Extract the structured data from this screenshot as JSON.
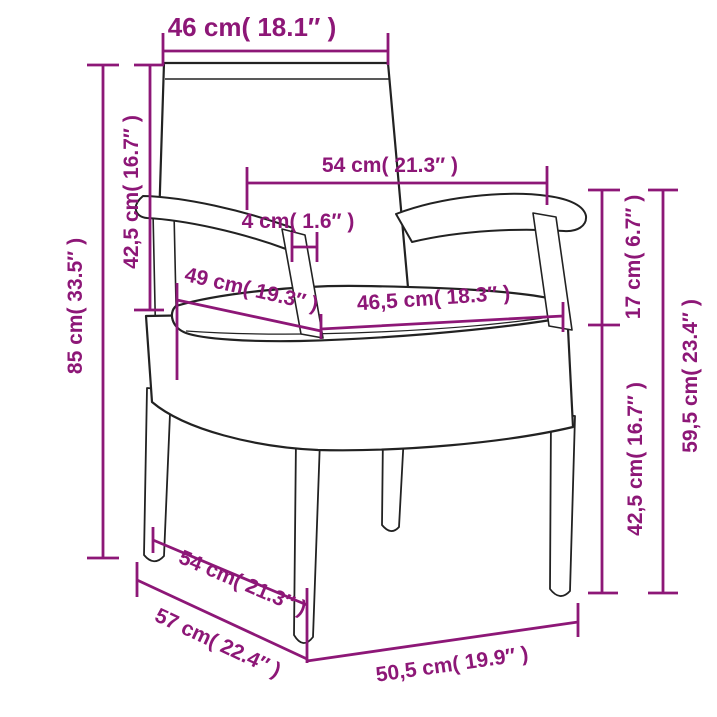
{
  "diagram": {
    "subject": "wicker-armchair-with-cushion",
    "background_color": "#ffffff",
    "dimension_color": "#8d1777",
    "outline_color": "#222222"
  },
  "labels": {
    "back_width": "46 cm( 18.1″ )",
    "back_height": "42,5 cm( 16.7″ )",
    "total_height": "85 cm( 33.5″ )",
    "armrest_span": "54 cm( 21.3″ )",
    "armrest_thickness": "4 cm( 1.6″ )",
    "seat_depth": "49 cm( 19.3″ )",
    "seat_width": "46,5 cm( 18.3″ )",
    "armrest_to_seat": "17 cm( 6.7″ )",
    "armrest_height": "59,5 cm( 23.4″ )",
    "seat_height": "42,5 cm( 16.7″ )",
    "base_depth_upper": "54 cm( 21.3″ )",
    "base_depth_lower": "57 cm( 22.4″ )",
    "base_width": "50,5 cm( 19.9″ )"
  }
}
